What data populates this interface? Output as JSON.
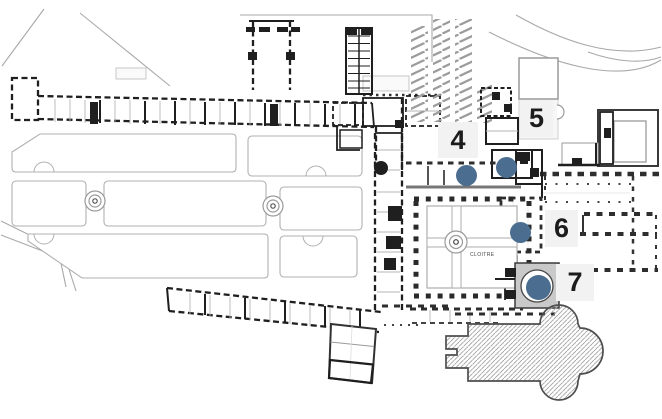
{
  "map": {
    "type": "architectural-site-plan",
    "cloister_label": "CLOITRE",
    "colors": {
      "marker_dot": "#4b6d90",
      "marker_label_bg": "#f2f2f2",
      "marker_label_text": "#1c1c1c",
      "plan_dark": "#1f1f1f",
      "plan_light_gray": "#b0b0b0",
      "church_hatch": "#9f9f9f"
    },
    "markers": [
      {
        "label": "4",
        "box": {
          "x": 438,
          "y": 122,
          "w": 40,
          "h": 36
        },
        "dot": {
          "x": 466,
          "y": 175,
          "r": 10.5
        }
      },
      {
        "label": "5",
        "box": {
          "x": 520,
          "y": 100,
          "w": 33,
          "h": 37
        },
        "dot": {
          "x": 506,
          "y": 167,
          "r": 10.5
        }
      },
      {
        "label": "6",
        "box": {
          "x": 545,
          "y": 210,
          "w": 33,
          "h": 37
        },
        "dot": {
          "x": 520,
          "y": 232,
          "r": 10.5
        }
      },
      {
        "label": "7",
        "box": {
          "x": 556,
          "y": 264,
          "w": 38,
          "h": 37
        },
        "dot": {
          "x": 538,
          "y": 287,
          "r": 12.5
        }
      }
    ]
  }
}
